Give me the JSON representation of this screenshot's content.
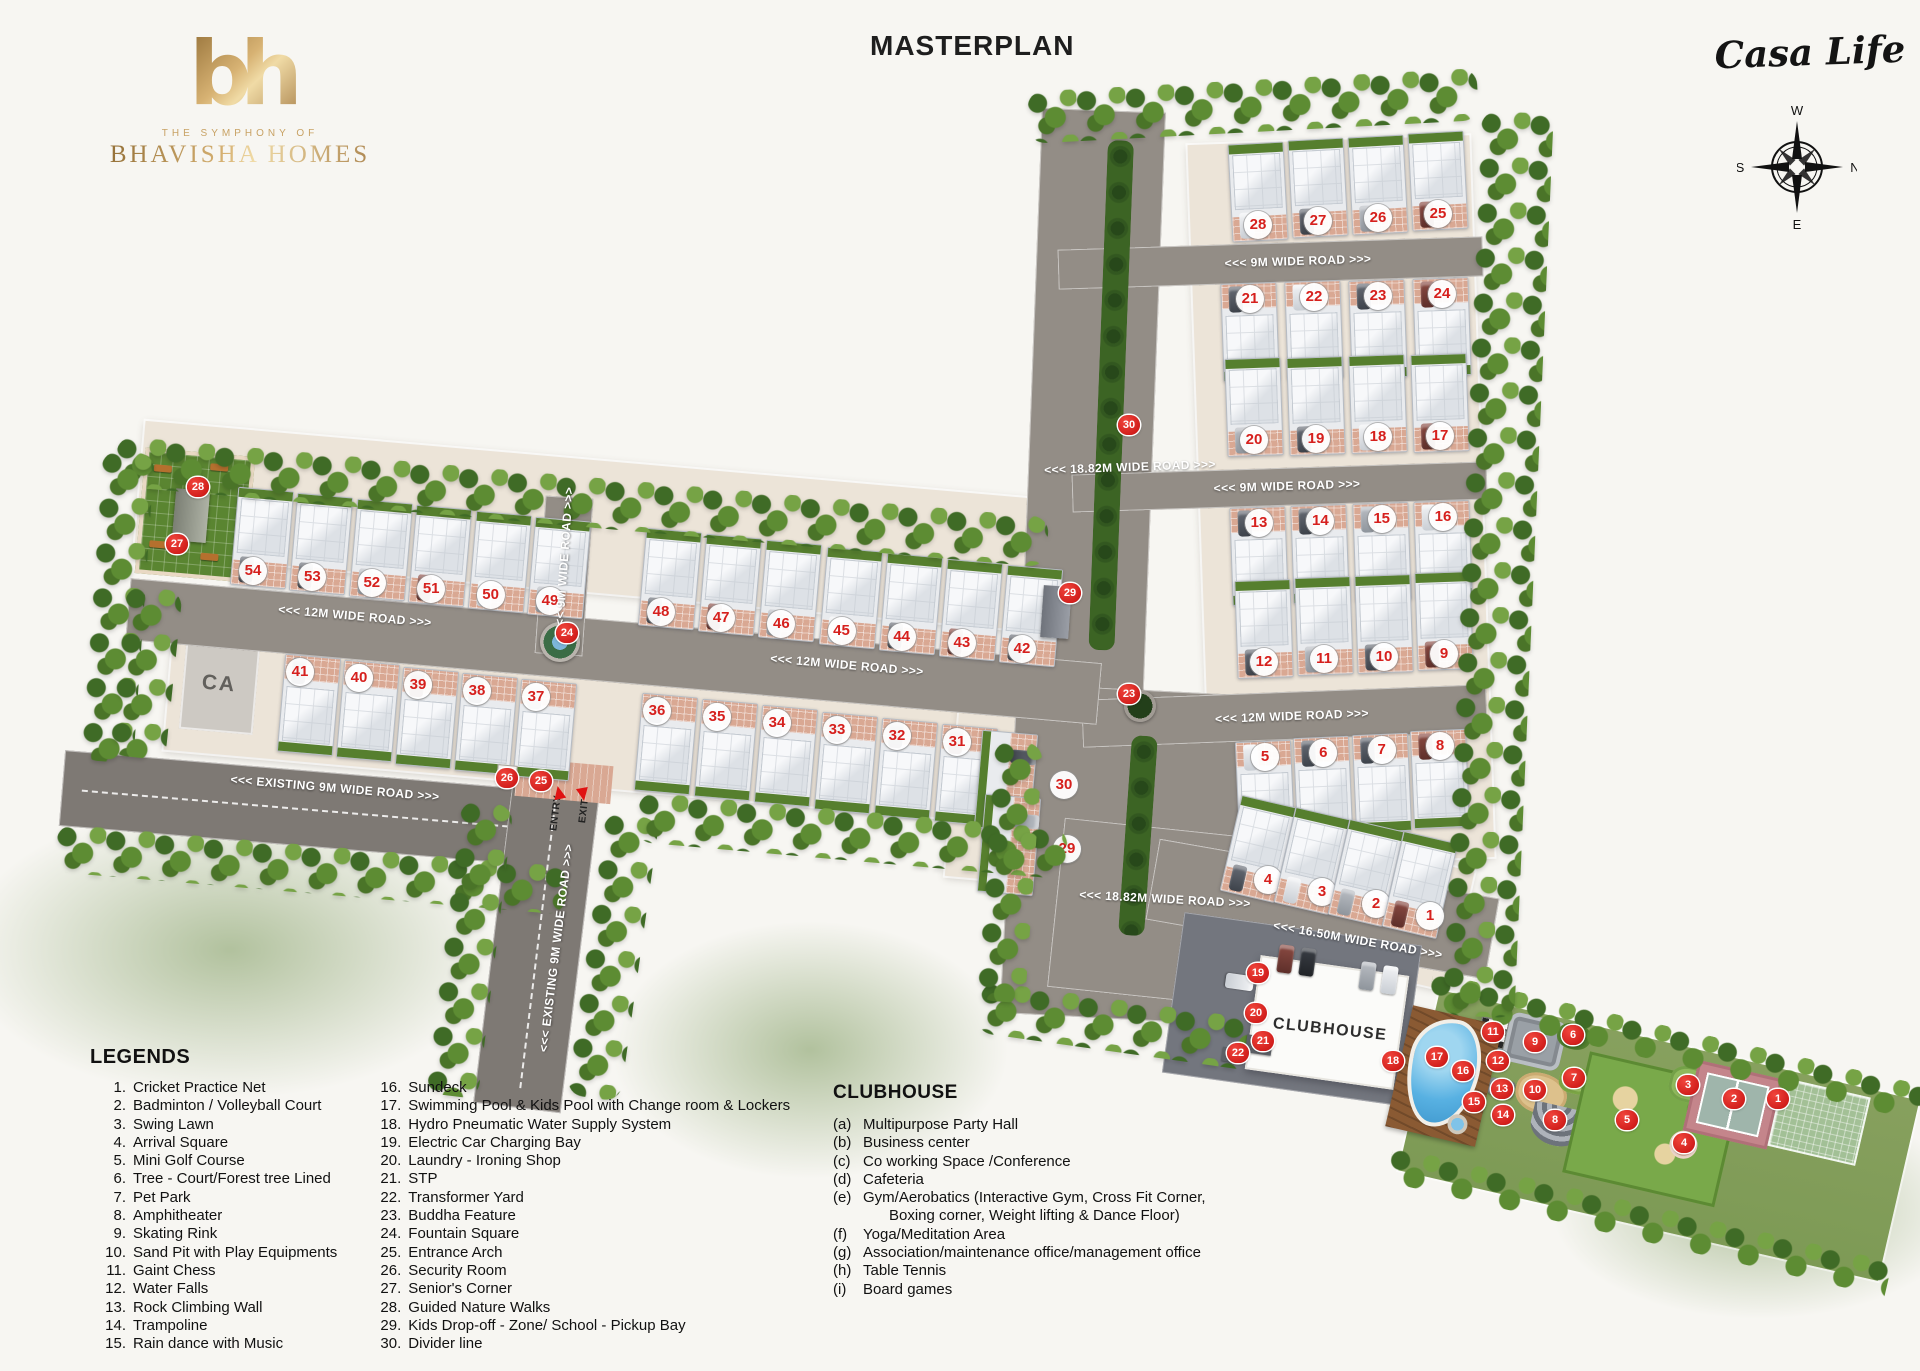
{
  "header": {
    "title": "MASTERPLAN"
  },
  "brand": {
    "monogram": "bh",
    "tagline": "THE SYMPHONY OF",
    "name": "BHAVISHA HOMES",
    "project": "Casa Life",
    "gold": "#bf9a55"
  },
  "compass": {
    "top": "W",
    "right": "N",
    "bottom": "E",
    "left": "S"
  },
  "legends": {
    "title": "LEGENDS",
    "col1": [
      {
        "n": "1.",
        "t": "Cricket Practice Net"
      },
      {
        "n": "2.",
        "t": "Badminton / Volleyball Court"
      },
      {
        "n": "3.",
        "t": "Swing Lawn"
      },
      {
        "n": "4.",
        "t": "Arrival Square"
      },
      {
        "n": "5.",
        "t": "Mini Golf Course"
      },
      {
        "n": "6.",
        "t": "Tree - Court/Forest tree Lined"
      },
      {
        "n": "7.",
        "t": "Pet Park"
      },
      {
        "n": "8.",
        "t": "Amphitheater"
      },
      {
        "n": "9.",
        "t": "Skating Rink"
      },
      {
        "n": "10.",
        "t": "Sand Pit with Play Equipments"
      },
      {
        "n": "11.",
        "t": "Gaint Chess"
      },
      {
        "n": "12.",
        "t": "Water Falls"
      },
      {
        "n": "13.",
        "t": "Rock Climbing Wall"
      },
      {
        "n": "14.",
        "t": "Trampoline"
      },
      {
        "n": "15.",
        "t": "Rain dance with Music"
      }
    ],
    "col2": [
      {
        "n": "16.",
        "t": "Sundeck"
      },
      {
        "n": "17.",
        "t": "Swimming Pool & Kids Pool with Change room & Lockers"
      },
      {
        "n": "18.",
        "t": "Hydro Pneumatic Water Supply System"
      },
      {
        "n": "19.",
        "t": "Electric Car Charging Bay"
      },
      {
        "n": "20.",
        "t": "Laundry - Ironing Shop"
      },
      {
        "n": "21.",
        "t": "STP"
      },
      {
        "n": "22.",
        "t": "Transformer Yard"
      },
      {
        "n": "23.",
        "t": "Buddha Feature"
      },
      {
        "n": "24.",
        "t": "Fountain Square"
      },
      {
        "n": "25.",
        "t": "Entrance Arch"
      },
      {
        "n": "26.",
        "t": "Security Room"
      },
      {
        "n": "27.",
        "t": "Senior's Corner"
      },
      {
        "n": "28.",
        "t": "Guided Nature Walks"
      },
      {
        "n": "29.",
        "t": "Kids Drop-off - Zone/ School - Pickup Bay"
      },
      {
        "n": "30.",
        "t": "Divider line"
      }
    ]
  },
  "clubhouse_legend": {
    "title": "CLUBHOUSE",
    "items": [
      {
        "k": "(a)",
        "t": "Multipurpose Party Hall"
      },
      {
        "k": "(b)",
        "t": "Business center"
      },
      {
        "k": "(c)",
        "t": "Co working Space /Conference"
      },
      {
        "k": "(d)",
        "t": "Cafeteria"
      },
      {
        "k": "(e)",
        "t": "Gym/Aerobatics (Interactive Gym, Cross Fit Corner,",
        "t2": "Boxing corner, Weight lifting & Dance Floor)"
      },
      {
        "k": "(f)",
        "t": "Yoga/Meditation Area"
      },
      {
        "k": "(g)",
        "t": "Association/maintenance office/management office"
      },
      {
        "k": "(h)",
        "t": "Table Tennis"
      },
      {
        "k": "(i)",
        "t": "Board games"
      }
    ]
  },
  "map": {
    "road_labels": [
      {
        "t": "<<< 9M WIDE ROAD >>>",
        "x": 1298,
        "y": 261,
        "r": -1.8
      },
      {
        "t": "<<< 18.82M WIDE ROAD >>>",
        "x": 1130,
        "y": 467,
        "r": -2
      },
      {
        "t": "<<< 9M WIDE ROAD >>>",
        "x": 1287,
        "y": 486,
        "r": -1.8
      },
      {
        "t": "<<< 9M WIDE ROAD >>>",
        "x": 564,
        "y": 560,
        "r": -86
      },
      {
        "t": "<<< 12M WIDE ROAD >>>",
        "x": 355,
        "y": 616,
        "r": 5
      },
      {
        "t": "<<< 12M WIDE ROAD >>>",
        "x": 847,
        "y": 665,
        "r": 5
      },
      {
        "t": "<<< 12M WIDE ROAD >>>",
        "x": 1292,
        "y": 716,
        "r": -2.2
      },
      {
        "t": "<<< EXISTING 9M WIDE ROAD >>>",
        "x": 335,
        "y": 788,
        "r": 4.8
      },
      {
        "t": "<<< EXISTING 9M WIDE ROAD >>>",
        "x": 556,
        "y": 948,
        "r": -83
      },
      {
        "t": "<<< 18.82M WIDE ROAD >>>",
        "x": 1165,
        "y": 899,
        "r": 3
      },
      {
        "t": "<<< 16.50M WIDE ROAD >>>",
        "x": 1358,
        "y": 940,
        "r": 10
      }
    ],
    "area_labels": [
      {
        "t": "CA",
        "x": 219,
        "y": 684,
        "r": 5,
        "cls": "ca",
        "name": "ca-area-label"
      },
      {
        "t": "CLUBHOUSE",
        "x": 1330,
        "y": 1030,
        "r": 6,
        "cls": "club",
        "name": "clubhouse-label"
      },
      {
        "t": "ENTRY",
        "x": 556,
        "y": 813,
        "r": -83,
        "cls": "gate",
        "name": "entry-label"
      },
      {
        "t": "EXIT",
        "x": 584,
        "y": 811,
        "r": -83,
        "cls": "gate",
        "name": "exit-label"
      }
    ],
    "plot_rows": [
      {
        "numbers": [
          54,
          53,
          52,
          51,
          50,
          49
        ],
        "x1": 253,
        "y1": 571,
        "x2": 550,
        "y2": 601,
        "hx": 9,
        "hy": -33,
        "rot": 5,
        "side": "nb"
      },
      {
        "numbers": [
          48,
          47,
          46,
          45,
          44,
          43,
          42
        ],
        "x1": 661,
        "y1": 612,
        "x2": 1022,
        "y2": 649,
        "hx": 9,
        "hy": -33,
        "rot": 5,
        "side": "nb"
      },
      {
        "numbers": [
          41,
          40,
          39,
          38,
          37
        ],
        "x1": 300,
        "y1": 672,
        "x2": 536,
        "y2": 697,
        "hx": 9,
        "hy": 33,
        "rot": 5,
        "side": "nt"
      },
      {
        "numbers": [
          36,
          35,
          34,
          33,
          32,
          31
        ],
        "x1": 657,
        "y1": 711,
        "x2": 957,
        "y2": 742,
        "hx": 9,
        "hy": 33,
        "rot": 5,
        "side": "nt"
      },
      {
        "numbers": [
          28,
          27,
          26,
          25
        ],
        "x1": 1258,
        "y1": 225,
        "x2": 1438,
        "y2": 214,
        "hx": 0,
        "hy": -33,
        "rot": -3,
        "side": "nb"
      },
      {
        "numbers": [
          21,
          22,
          23,
          24
        ],
        "x1": 1250,
        "y1": 299,
        "x2": 1442,
        "y2": 294,
        "hx": 0,
        "hy": 33,
        "rot": -2,
        "side": "nt"
      },
      {
        "numbers": [
          20,
          19,
          18,
          17
        ],
        "x1": 1254,
        "y1": 440,
        "x2": 1440,
        "y2": 436,
        "hx": 0,
        "hy": -33,
        "rot": -2,
        "side": "nb"
      },
      {
        "numbers": [
          13,
          14,
          15,
          16
        ],
        "x1": 1259,
        "y1": 523,
        "x2": 1443,
        "y2": 517,
        "hx": 0,
        "hy": 33,
        "rot": -2,
        "side": "nt"
      },
      {
        "numbers": [
          12,
          11,
          10,
          9
        ],
        "x1": 1264,
        "y1": 662,
        "x2": 1444,
        "y2": 654,
        "hx": 0,
        "hy": -33,
        "rot": -2,
        "side": "nb"
      },
      {
        "numbers": [
          5,
          6,
          7,
          8
        ],
        "x1": 1265,
        "y1": 757,
        "x2": 1440,
        "y2": 746,
        "hx": 0,
        "hy": 33,
        "rot": -2.5,
        "side": "nt"
      },
      {
        "numbers": [
          4,
          3,
          2,
          1
        ],
        "x1": 1268,
        "y1": 880,
        "x2": 1430,
        "y2": 916,
        "hx": -10,
        "hy": -31,
        "rot": 13,
        "side": "nb"
      },
      {
        "numbers": [
          30
        ],
        "x1": 1064,
        "y1": 785,
        "x2": 1064,
        "y2": 785,
        "hx": -58,
        "hy": -4,
        "rot": 5,
        "side": "nr"
      },
      {
        "numbers": [
          29
        ],
        "x1": 1067,
        "y1": 849,
        "x2": 1067,
        "y2": 849,
        "hx": -58,
        "hy": -4,
        "rot": 5,
        "side": "nr"
      }
    ],
    "amenity_badges": [
      {
        "n": 1,
        "x": 1777,
        "y": 1099
      },
      {
        "n": 2,
        "x": 1733,
        "y": 1099
      },
      {
        "n": 3,
        "x": 1687,
        "y": 1085
      },
      {
        "n": 4,
        "x": 1683,
        "y": 1143
      },
      {
        "n": 5,
        "x": 1626,
        "y": 1120
      },
      {
        "n": 6,
        "x": 1572,
        "y": 1035
      },
      {
        "n": 7,
        "x": 1573,
        "y": 1078
      },
      {
        "n": 8,
        "x": 1554,
        "y": 1120
      },
      {
        "n": 9,
        "x": 1534,
        "y": 1042
      },
      {
        "n": 10,
        "x": 1534,
        "y": 1090
      },
      {
        "n": 11,
        "x": 1492,
        "y": 1032
      },
      {
        "n": 12,
        "x": 1497,
        "y": 1061
      },
      {
        "n": 13,
        "x": 1501,
        "y": 1089
      },
      {
        "n": 14,
        "x": 1502,
        "y": 1115
      },
      {
        "n": 15,
        "x": 1473,
        "y": 1102
      },
      {
        "n": 16,
        "x": 1462,
        "y": 1071
      },
      {
        "n": 17,
        "x": 1436,
        "y": 1057
      },
      {
        "n": 18,
        "x": 1392,
        "y": 1061
      },
      {
        "n": 19,
        "x": 1257,
        "y": 973
      },
      {
        "n": 20,
        "x": 1255,
        "y": 1013
      },
      {
        "n": 21,
        "x": 1262,
        "y": 1041
      },
      {
        "n": 22,
        "x": 1237,
        "y": 1053
      },
      {
        "n": 23,
        "x": 1128,
        "y": 694
      },
      {
        "n": 24,
        "x": 566,
        "y": 633
      },
      {
        "n": 25,
        "x": 540,
        "y": 781
      },
      {
        "n": 26,
        "x": 506,
        "y": 778
      },
      {
        "n": 27,
        "x": 176,
        "y": 544
      },
      {
        "n": 28,
        "x": 197,
        "y": 487
      },
      {
        "n": 29,
        "x": 1069,
        "y": 593
      },
      {
        "n": 30,
        "x": 1128,
        "y": 425
      }
    ]
  }
}
